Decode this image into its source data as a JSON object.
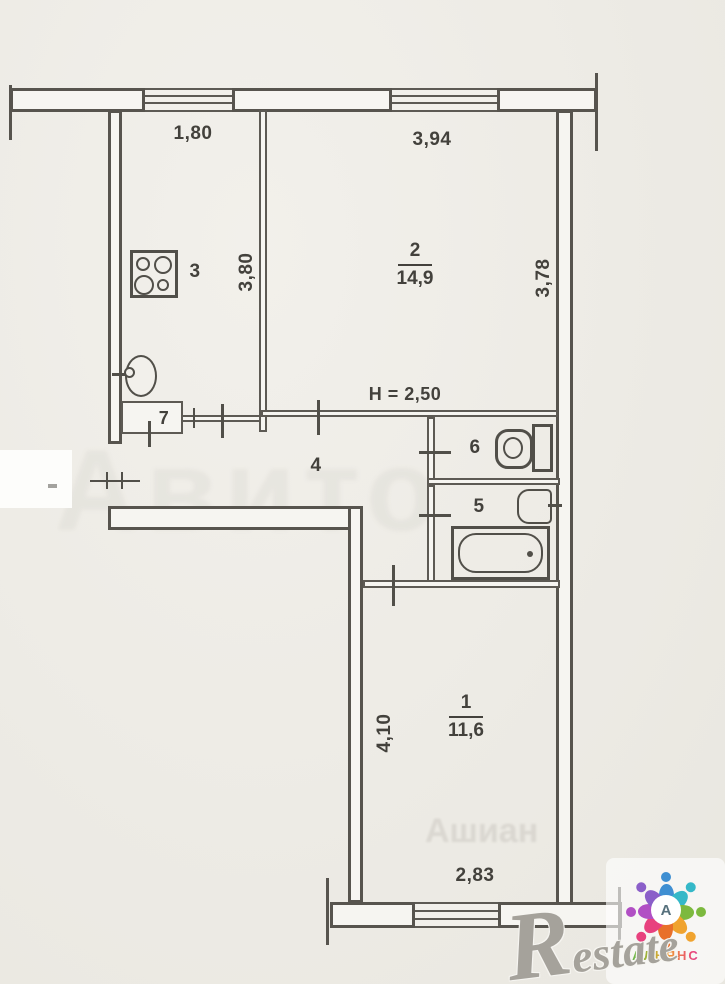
{
  "dims": {
    "top_left": "1,80",
    "top_right": "3,94",
    "kitchen_depth": "3,80",
    "room2_depth": "3,78",
    "height_note": "H = 2,50",
    "room1_depth": "4,10",
    "room1_width": "2,83"
  },
  "rooms": {
    "room1": {
      "number": "1",
      "area": "11,6"
    },
    "room2": {
      "number": "2",
      "area": "14,9"
    },
    "kitchen": {
      "number": "3"
    },
    "hallway": {
      "number": "4"
    },
    "bathroom": {
      "number": "5"
    },
    "wc": {
      "number": "6"
    },
    "closet": {
      "number": "7"
    }
  },
  "watermarks": {
    "restate": "Restate",
    "ghost_center": "Авито",
    "ghost_bottom": "Ашиан",
    "agency_initial": "А",
    "agency_name": "АЛЬЯНС"
  },
  "colors": {
    "wall_line": "#57544e",
    "paper": "#edebe5",
    "label_text": "#43413c",
    "petals": [
      "#3f8fd2",
      "#35b8c8",
      "#7cb93e",
      "#f0a32f",
      "#e8702a",
      "#e8417e",
      "#b14fc4",
      "#8b5fc9"
    ]
  }
}
